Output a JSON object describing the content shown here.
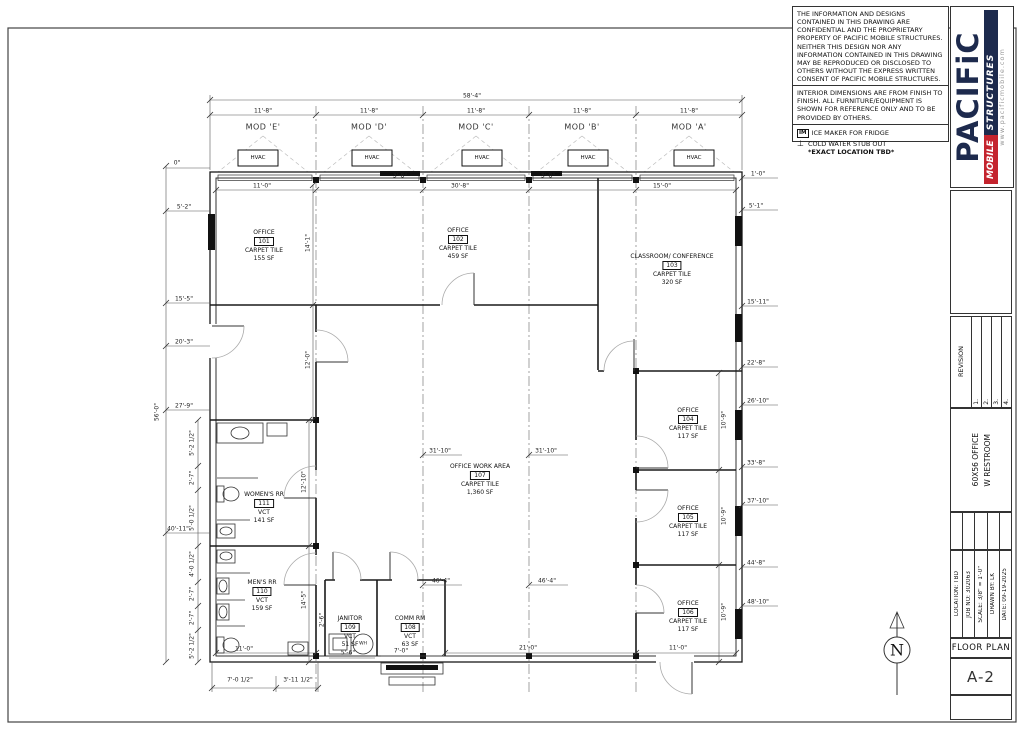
{
  "notes": {
    "confidential": "THE INFORMATION AND DESIGNS CONTAINED IN THIS DRAWING ARE CONFIDENTIAL AND THE PROPRIETARY PROPERTY OF PACIFIC MOBILE STRUCTURES. NEITHER THIS DESIGN NOR ANY INFORMATION CONTAINED IN THIS DRAWING MAY BE REPRODUCED OR DISCLOSED TO OTHERS WITHOUT THE EXPRESS WRITTEN CONSENT OF PACIFIC MOBILE STRUCTURES.",
    "interior": "INTERIOR DIMENSIONS ARE FROM FINISH TO FINISH. ALL FURNITURE/EQUIPMENT IS SHOWN FOR REFERENCE ONLY AND TO BE PROVIDED BY OTHERS.",
    "ice_symbol": "IM",
    "ice_maker": "ICE MAKER FOR FRIDGE",
    "cold_symbol": "⊥",
    "cold_water_1": "COLD WATER STUB OUT",
    "cold_water_2": "*EXACT LOCATION TBD*"
  },
  "logo": {
    "name": "PACIFiC",
    "mobile": "MOBILE",
    "structures": "STRUCTURES",
    "website": "www.pacificmobile.com",
    "navy": "#1d2a4d",
    "red": "#c4242e"
  },
  "titleblock": {
    "revision_label": "REVISION",
    "revision_rows": [
      "1.",
      "2.",
      "3.",
      "4."
    ],
    "project_line1": "60X56 OFFICE",
    "project_line2": "W RESTROOM",
    "location": "LOCATION: TBD",
    "job_no": "JOB NO: 302063",
    "scale": "SCALE: 3/8\" = 1'-0\"",
    "drawn_by": "DRAWN BY: LK",
    "date": "DATE: 09-19-2025",
    "sheet_title": "FLOOR PLAN",
    "sheet_no": "A-2"
  },
  "plan": {
    "modules": [
      "MOD 'E'",
      "MOD 'D'",
      "MOD 'C'",
      "MOD 'B'",
      "MOD 'A'"
    ],
    "hvac_label": "HVAC",
    "wh_label": "WH",
    "north_label": "N",
    "rooms": [
      {
        "name": "OFFICE",
        "number": "101",
        "finish": "CARPET TILE",
        "area": "155 SF"
      },
      {
        "name": "OFFICE",
        "number": "102",
        "finish": "CARPET TILE",
        "area": "459 SF"
      },
      {
        "name": "CLASSROOM/ CONFERENCE",
        "number": "103",
        "finish": "CARPET TILE",
        "area": "320 SF"
      },
      {
        "name": "OFFICE",
        "number": "104",
        "finish": "CARPET TILE",
        "area": "117 SF"
      },
      {
        "name": "OFFICE",
        "number": "105",
        "finish": "CARPET TILE",
        "area": "117 SF"
      },
      {
        "name": "OFFICE",
        "number": "106",
        "finish": "CARPET TILE",
        "area": "117 SF"
      },
      {
        "name": "OFFICE WORK AREA",
        "number": "107",
        "finish": "CARPET TILE",
        "area": "1,360 SF"
      },
      {
        "name": "COMM RM",
        "number": "108",
        "finish": "VCT",
        "area": "63 SF"
      },
      {
        "name": "JANITOR",
        "number": "109",
        "finish": "VCT",
        "area": "51 SF"
      },
      {
        "name": "MEN'S RR",
        "number": "110",
        "finish": "VCT",
        "area": "159 SF"
      },
      {
        "name": "WOMEN'S RR",
        "number": "111",
        "finish": "VCT",
        "area": "141 SF"
      }
    ],
    "dims_top": [
      "0\"",
      "58'-4\"",
      "11'-8\"",
      "11'-8\"",
      "11'-8\"",
      "11'-8\"",
      "11'-8\"",
      "11'-0\"",
      "3'-8\"",
      "30'-8\"",
      "3'-8\"",
      "15'-0\"",
      "1'-0\""
    ],
    "dims_left": [
      "5'-2\"",
      "15'-5\"",
      "20'-3\"",
      "27'-9\"",
      "40'-11\"",
      "56'-0\"",
      "5'-2 1/2\"",
      "2'-7\"",
      "5'-0 1/2\"",
      "4'-0 1/2\"",
      "2'-7\"",
      "2'-7\"",
      "5'-2 1/2\""
    ],
    "dims_right": [
      "5'-1\"",
      "15'-11\"",
      "22'-8\"",
      "26'-10\"",
      "33'-8\"",
      "37'-10\"",
      "44'-8\"",
      "48'-10\""
    ],
    "dims_inner": [
      "14'-1\"",
      "12'-0\"",
      "31'-10\"",
      "31'-10\"",
      "12'-10\"",
      "14'-5\"",
      "10'-9\"",
      "10'-9\"",
      "10'-9\"",
      "46'-4\"",
      "46'-4\"",
      "11'-0\"",
      "5'-6\"",
      "7'-0\"",
      "21'-0\"",
      "11'-0\"",
      "2'-6\"",
      "7'-0 1/2\"",
      "3'-11 1/2\""
    ]
  }
}
